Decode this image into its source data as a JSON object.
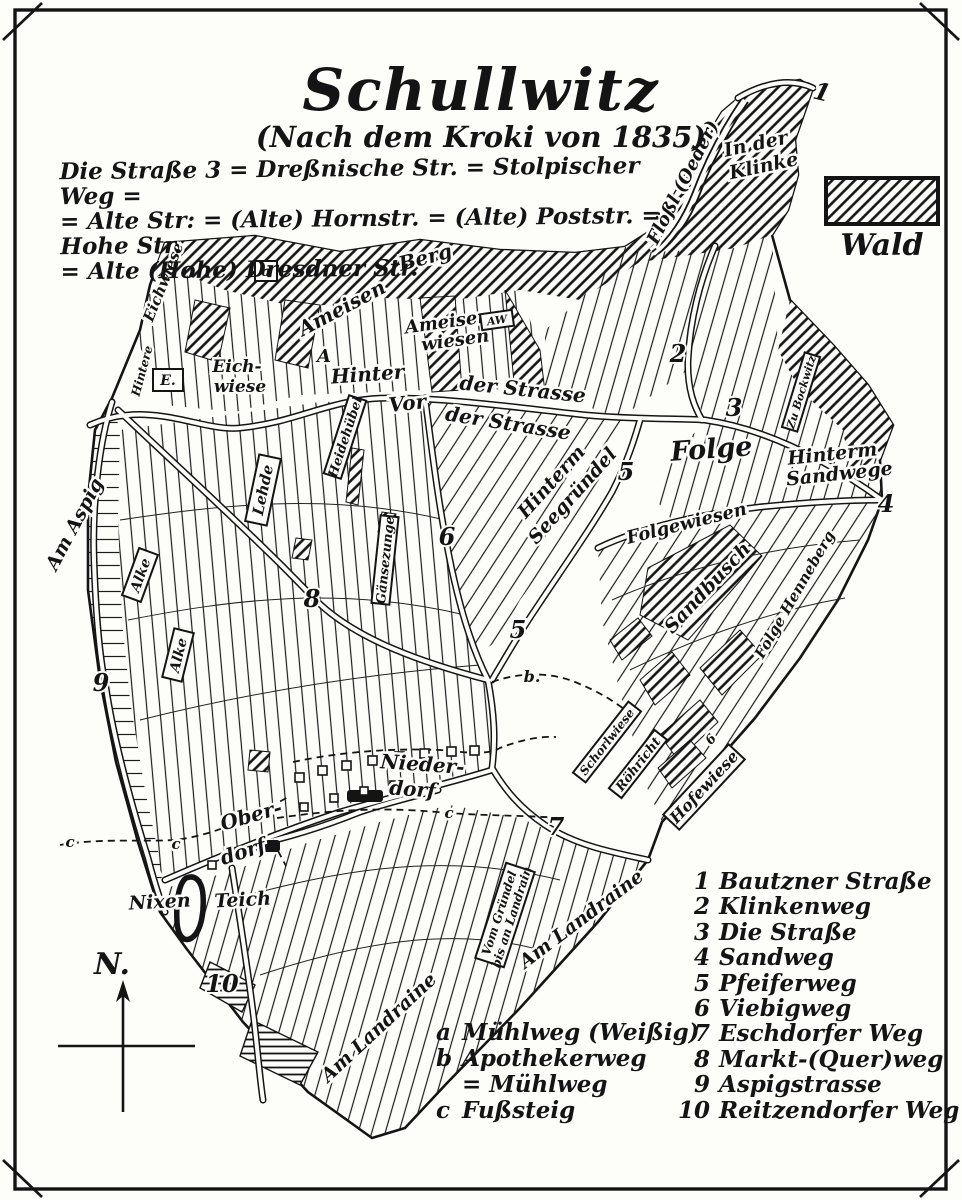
{
  "title": "Schullwitz",
  "subtitle": "(Nach dem Kroki von 1835)",
  "note_lines": [
    "Die Straße 3 = Dreßnische Str. = Stolpischer Weg =",
    "= Alte Str: = (Alte) Hornstr. = (Alte) Poststr. = Hohe Str.",
    "= Alte (Hohe) Dresdner Str."
  ],
  "legend": {
    "wald": "Wald"
  },
  "compass": {
    "north": "N."
  },
  "road_index": [
    {
      "num": "1",
      "name": "Bautzner Straße"
    },
    {
      "num": "2",
      "name": "Klinkenweg"
    },
    {
      "num": "3",
      "name": "Die Straße"
    },
    {
      "num": "4",
      "name": "Sandweg"
    },
    {
      "num": "5",
      "name": "Pfeiferweg"
    },
    {
      "num": "6",
      "name": "Viebigweg"
    },
    {
      "num": "7",
      "name": "Eschdorfer Weg"
    },
    {
      "num": "8",
      "name": "Markt-(Quer)weg"
    },
    {
      "num": "9",
      "name": "Aspigstrasse"
    },
    {
      "num": "10",
      "name": "Reitzendorfer Weg"
    }
  ],
  "path_index": [
    {
      "key": "a",
      "name": "Mühlweg (Weißig)"
    },
    {
      "key": "b",
      "name": "Apothekerweg"
    },
    {
      "key": "",
      "name": "= Mühlweg"
    },
    {
      "key": "c",
      "name": "Fußsteig"
    }
  ],
  "map_labels": {
    "n1": "1",
    "n2": "2",
    "n3": "3",
    "n4": "4",
    "n5_upper": "5",
    "n5_lower": "5",
    "n6": "6",
    "n6_small": "6",
    "n7": "7",
    "n8": "8",
    "n9": "9",
    "n10": "10",
    "a_box": "a",
    "cap_a": "A",
    "aw_box": "AW",
    "e_box": "E.",
    "b_dot": "b.",
    "c1": "c",
    "c2": "c",
    "c3": "c",
    "floessl": "Flößl (Oeder)",
    "in_der": "In der",
    "klinke": "Klinke",
    "eichwiese_corner": "Eichwiese",
    "hintere": "Hintere",
    "eich": "Eich-",
    "wiese": "wiese",
    "ameisen": "Ameisen",
    "berg": "Berg",
    "ameisen2": "Ameisen-",
    "wiesen": "wiesen",
    "hinter": "Hinter",
    "der_strasse1": "der Strasse",
    "vor": "Vor",
    "der_strasse2": "der Strasse",
    "folge": "Folge",
    "hinterm": "Hinterm",
    "sandwege": "Sandwege",
    "zu_bockwitz": "Zu Bockwitz",
    "hinterm2": "Hinterm",
    "seegruendel": "Seegründel",
    "folgewiesen": "Folgewiesen",
    "sandbusch": "Sandbusch",
    "folge_henneberg": "Folge Henneberg",
    "lehde": "Lehde",
    "heidehuebel": "Heidehübel",
    "gaensezunge": "Gänsezunge",
    "am_aspig": "Am Aspig",
    "alke1": "Alke",
    "alke2": "Alke",
    "schorlwiese": "Schorlwiese",
    "roehricht": "Röhricht",
    "hofewiese": "Hofewiese",
    "nieder": "Nieder-",
    "dorf1": "dorf",
    "ober": "Ober-",
    "dorf2": "dorf",
    "nixen": "Nixen",
    "teich": "Teich",
    "am_landraine1": "Am Landraine",
    "am_landraine2": "Am Landraine",
    "vom_gruendel1": "Vom Gründel",
    "vom_gruendel2": "bis an Landrain"
  }
}
